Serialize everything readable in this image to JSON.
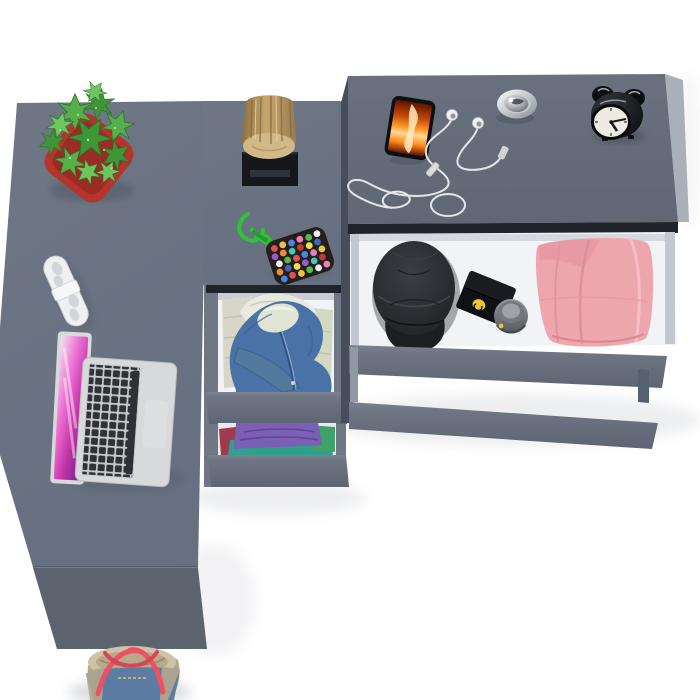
{
  "scene": {
    "description": "Top view of a gray corner desk with a drawer column and dresser, open drawers with clothes and accessories, objects on surfaces and a tote bag on the floor",
    "colors": {
      "floor": "#ffffff",
      "surface": "#6b7382",
      "surfaceSide": "#5c московской6470",
      "deskFront": "#5c6470",
      "dresserTop": "#68707d",
      "drawerFront": "#6a7280",
      "sideDark": "#474e59",
      "gap": "#20242a",
      "interior": "#f2f3f6",
      "potRed": "#b5352d",
      "leafGreen": "#3f9638",
      "remoteWhite": "#eef0f2",
      "laptopSilver": "#d7d9db",
      "keyDark": "#2e3136",
      "hoodieBlue": "#4a72a6",
      "hoodLining": "#dfe4d4",
      "shirtPurple": "#7a5fb5",
      "clothTeal": "#2ea08c",
      "clothMaroon": "#a03a50",
      "clothGreen": "#3fa06a",
      "pantsPink": "#eea6ad",
      "capBlack": "#2c2d31",
      "boxBlack": "#101114",
      "logoYellow": "#e8c53a",
      "jarGray": "#7d8085",
      "cordGreen": "#2fc436",
      "bagDenim": "#5d7ca3",
      "bagBeige": "#b3a78d",
      "strapRed": "#ee5063",
      "clockFace": "#eceae3",
      "clockBlack": "#16171b",
      "chromeSilver": "#c7cbd1"
    },
    "objects": [
      {
        "id": "desk",
        "label": "gray corner desk"
      },
      {
        "id": "drawer-column",
        "label": "drawer column with two open clothes drawers"
      },
      {
        "id": "dresser",
        "label": "dresser with open accessory drawer"
      },
      {
        "id": "plant",
        "label": "succulent in red pot"
      },
      {
        "id": "remote",
        "label": "white remote control"
      },
      {
        "id": "laptop",
        "label": "open silver laptop with pink wallpaper"
      },
      {
        "id": "wood-stump",
        "label": "decorative wood log on black stand"
      },
      {
        "id": "pompom-keychain",
        "label": "green paracord keychain with beaded pouch"
      },
      {
        "id": "smartphone",
        "label": "smartphone with fire wallpaper"
      },
      {
        "id": "earbuds",
        "label": "white wired earbuds"
      },
      {
        "id": "metal-knob",
        "label": "round chrome trinket"
      },
      {
        "id": "alarm-clock",
        "label": "black twin-bell alarm clock"
      },
      {
        "id": "black-cap",
        "label": "black cadet cap"
      },
      {
        "id": "black-box",
        "label": "black box with yellow logo"
      },
      {
        "id": "gray-jar",
        "label": "small gray jar"
      },
      {
        "id": "pink-pants",
        "label": "folded pink trousers"
      },
      {
        "id": "blue-hoodie",
        "label": "blue hoodie in open drawer"
      },
      {
        "id": "folded-clothes",
        "label": "folded purple, teal and green clothes"
      },
      {
        "id": "tote-bag",
        "label": "denim and beige tote bag on floor"
      }
    ]
  }
}
